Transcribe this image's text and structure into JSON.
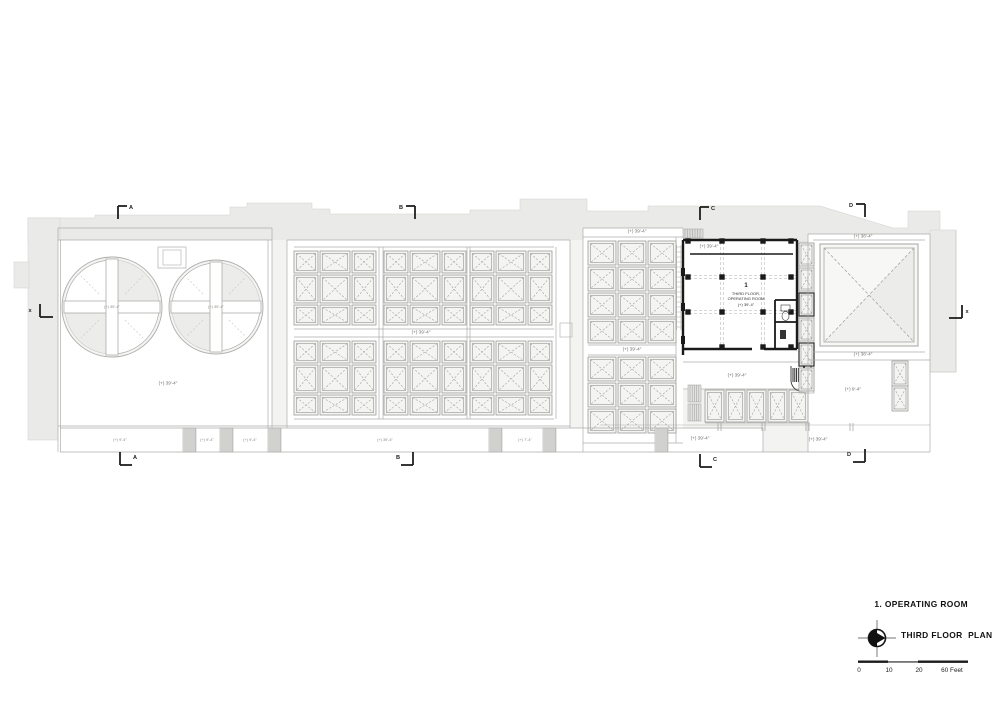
{
  "colors": {
    "paper": "#ffffff",
    "massing": "#eaeae9",
    "massing_light": "#f3f3f2",
    "line": "#adadab",
    "panel_line": "#9c9c9a",
    "panel_fill": "#f4f4f2",
    "panel_tint": "#ececea",
    "hatch": "#9a9a98",
    "wall": "#1a1a1a",
    "dark": "#1c1c1c"
  },
  "title_block": {
    "drawing_label": "1. OPERATING ROOM",
    "plan_title": "THIRD FLOOR  PLAN"
  },
  "scale_bar": {
    "tick0": "0",
    "tick10": "10",
    "tick20": "20",
    "end_label": "60 Feet"
  },
  "operating_room_label": {
    "number": "1",
    "line1": "THIRD FLOOR,",
    "line2": "OPERATING ROOM",
    "elevation": "(+) 39'-4\""
  },
  "section_markers": {
    "top_a": "A",
    "top_b": "B",
    "top_c": "C",
    "top_d": "D",
    "bottom_a": "A",
    "bottom_b": "B",
    "bottom_c": "C",
    "bottom_d": "D",
    "left_x": "x",
    "right_x": "x"
  },
  "elevations": {
    "circle_1": "(+) 39'-4\"",
    "circle_2": "(+) 39'-4\"",
    "left_room": "(+) 39'-4\"",
    "grid_center": "(+) 39'-4\"",
    "c_section_top": "(+) 39'-4\"",
    "or_top": "(+) 39'-4\"",
    "c_grid_mid": "(+) 39'-4\"",
    "corridor": "(+) 39'-4\"",
    "c_bottom": "(+) 39'-4\"",
    "terrace_right": "(+) 39'-4\"",
    "sky_top": "(+) 38'-4\"",
    "sky_bottom": "(+) 38'-4\"",
    "room_right": "(+) 9'-4\"",
    "balcony_1": "(+) 9'-4\"",
    "balcony_2": "(+) 9'-4\"",
    "balcony_3": "(+) 9'-4\"",
    "balcony_4": "(+) 39'-4\"",
    "balcony_5": "(+) 7'-4\""
  }
}
